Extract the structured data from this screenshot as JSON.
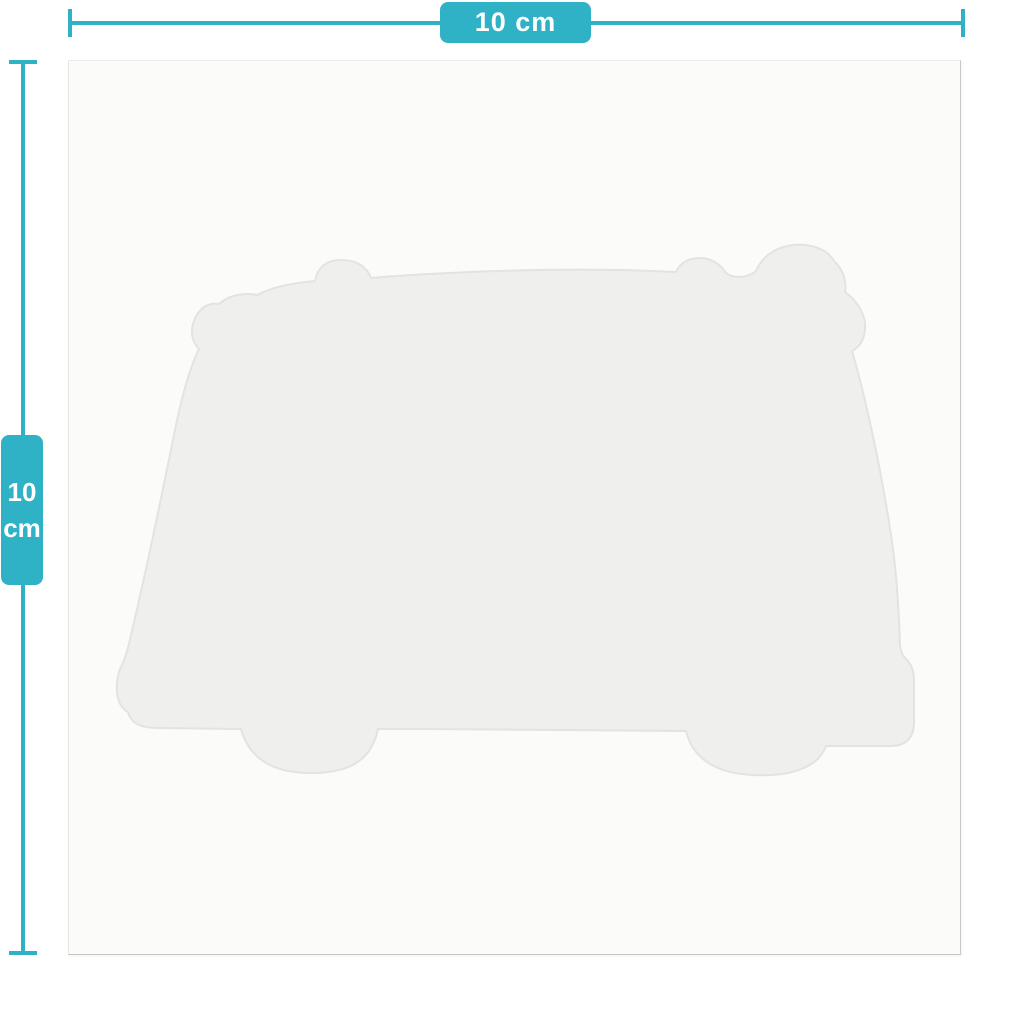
{
  "colors": {
    "accent": "#2fb1c6",
    "page_bg": "#ffffff",
    "sheet_bg": "#fbfbfa",
    "sheet_border": "#c9c9c7",
    "shape_fill": "#efefed",
    "shape_stroke": "#e3e3e0",
    "label_text": "#ffffff"
  },
  "width_dimension": {
    "label": "10 cm"
  },
  "height_dimension": {
    "value": "10",
    "unit": "cm"
  },
  "shape": {
    "icon": "camper-van-silhouette"
  }
}
